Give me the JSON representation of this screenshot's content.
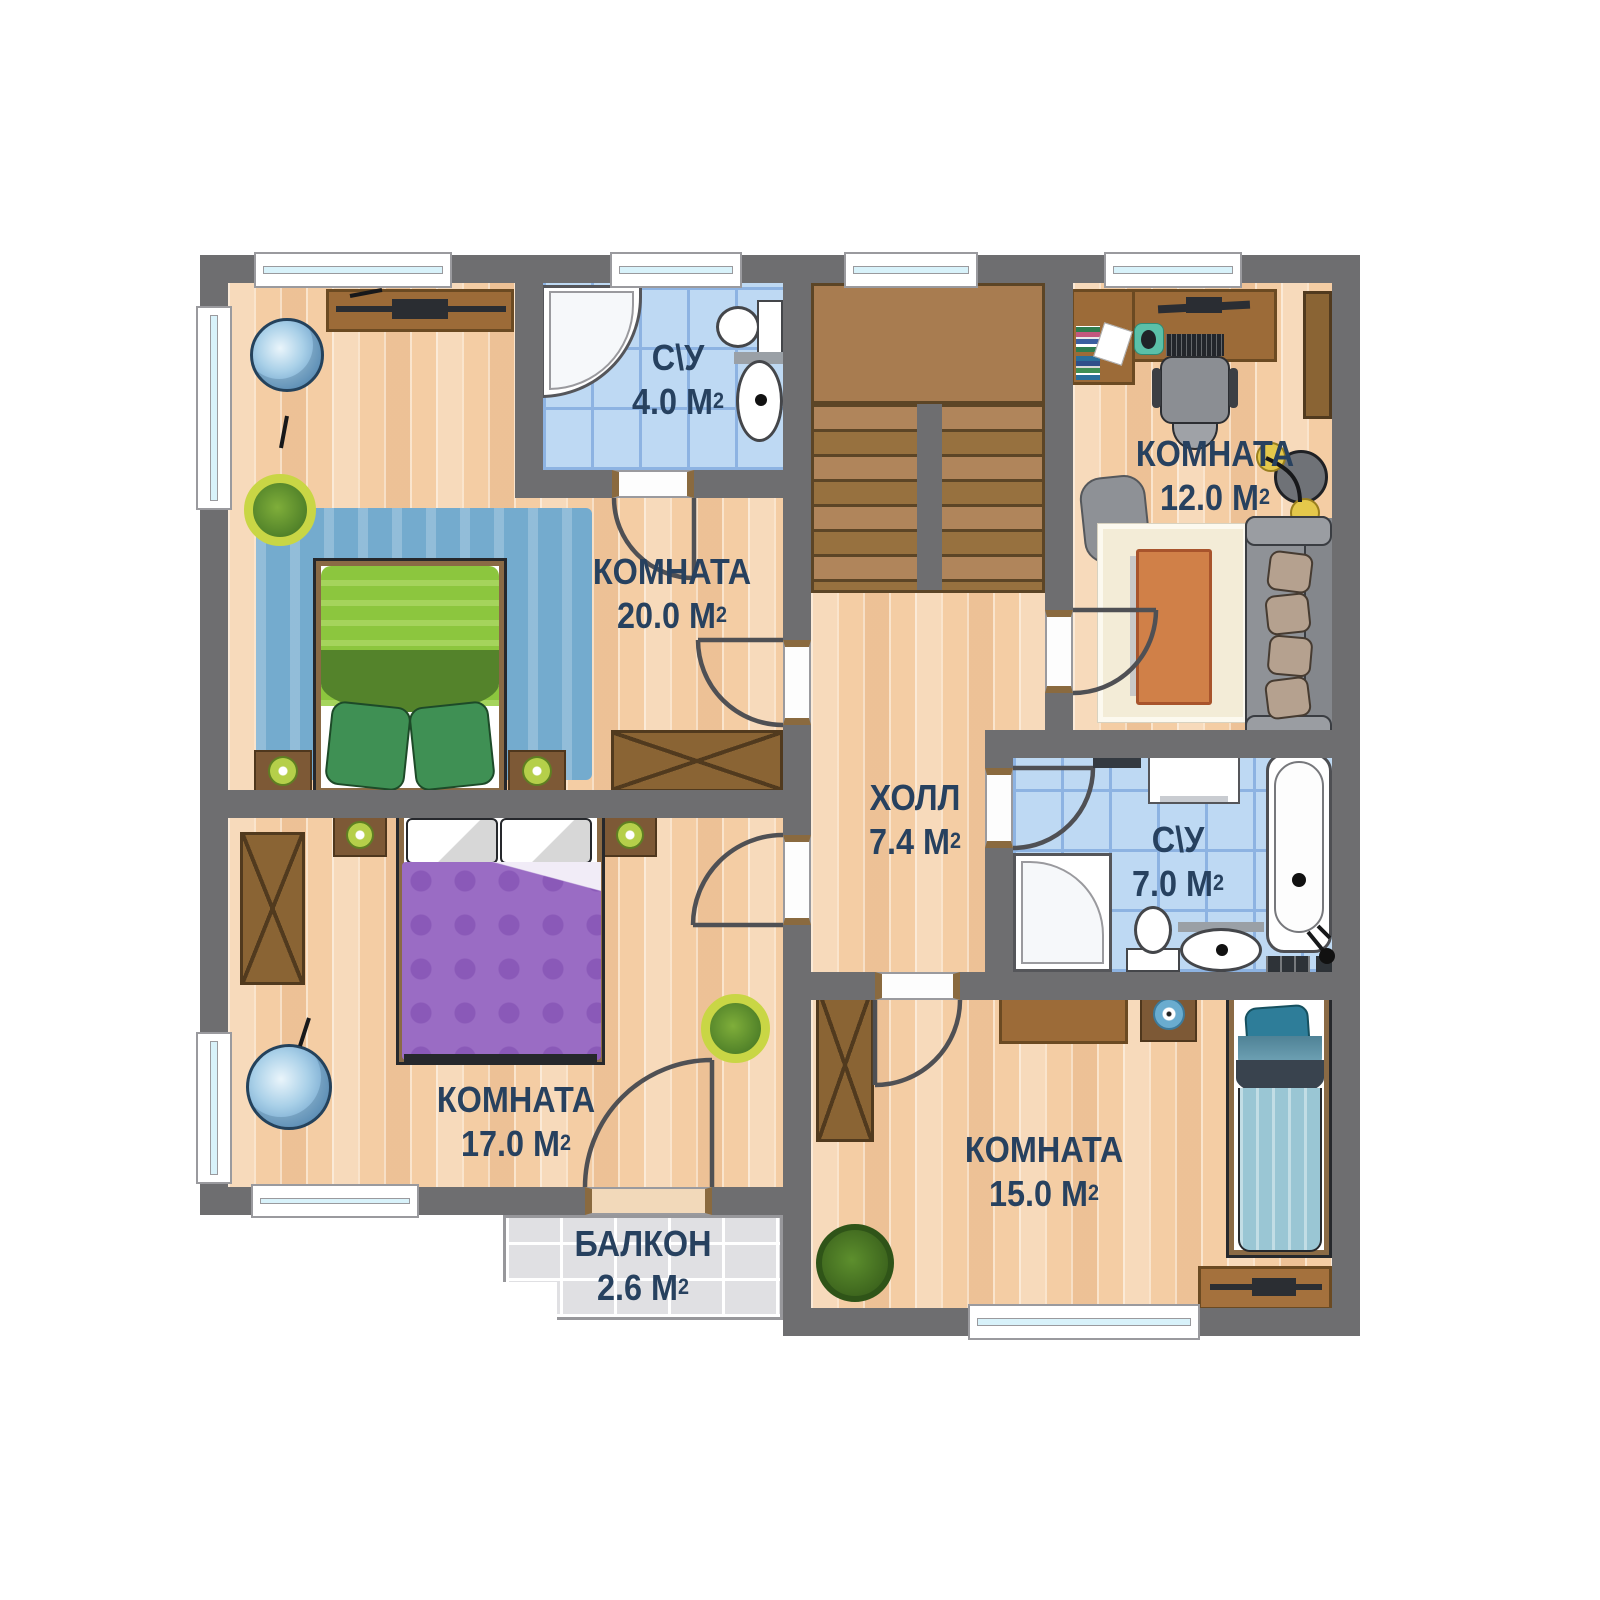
{
  "plan": {
    "type": "apartment-floor-plan",
    "language": "ru",
    "colors": {
      "wall": "#6e6e70",
      "wood_floor": "#f4cda4",
      "bath_tile": "#bed9f3",
      "balcony_tile": "#e0e0e3",
      "label_text": "#27415f",
      "stairs": "#a87c50",
      "rug_blue": "#74abce",
      "bed_green": "#8cc63e",
      "blanket_purple": "#9a6cc4",
      "bed_teal": "#9ac6d4",
      "furniture_brown": "#9c6b38"
    },
    "furniture": [
      "tv-stand",
      "armchair",
      "plant",
      "double-bed",
      "nightstand",
      "lamp",
      "wardrobe",
      "shower",
      "toilet",
      "sink",
      "bathtub",
      "washing-machine",
      "stairs",
      "desk",
      "office-chair",
      "books",
      "monitor",
      "keyboard",
      "mouse-pad",
      "dumbbells",
      "pouf",
      "rug",
      "coffee-table",
      "sofa",
      "single-bed",
      "dresser"
    ]
  },
  "rooms": [
    {
      "name": "С\\У",
      "area": "4.0",
      "unit": " М",
      "sup": "2"
    },
    {
      "name": "КОМНАТА",
      "area": "20.0",
      "unit": " М",
      "sup": "2"
    },
    {
      "name": "КОМНАТА",
      "area": "12.0",
      "unit": " М",
      "sup": "2"
    },
    {
      "name": "ХОЛЛ",
      "area": "7.4",
      "unit": " М",
      "sup": "2"
    },
    {
      "name": "С\\У",
      "area": "7.0",
      "unit": " М",
      "sup": "2"
    },
    {
      "name": "КОМНАТА",
      "area": "17.0",
      "unit": " М",
      "sup": "2"
    },
    {
      "name": "КОМНАТА",
      "area": "15.0",
      "unit": " М",
      "sup": "2"
    },
    {
      "name": "БАЛКОН",
      "area": "2.6",
      "unit": " М",
      "sup": "2"
    }
  ]
}
